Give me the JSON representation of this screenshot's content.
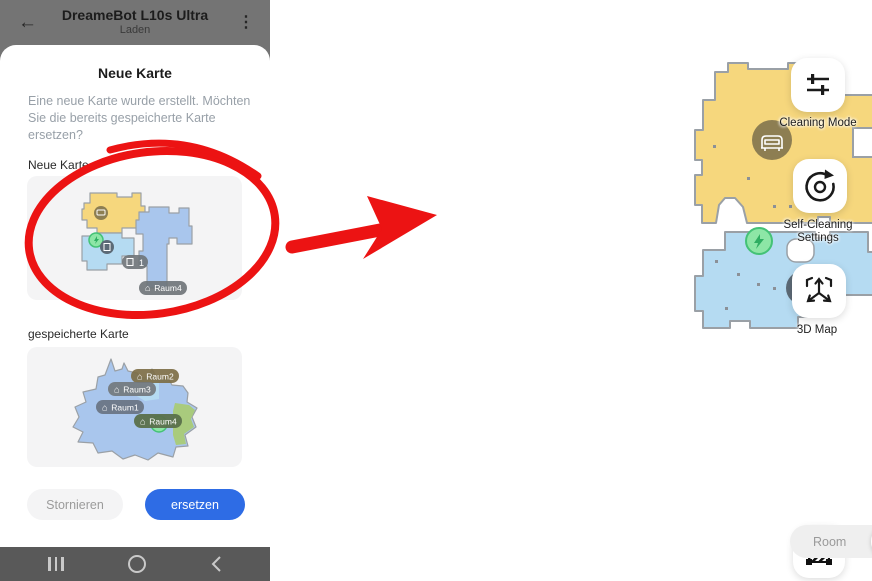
{
  "icons": {
    "back": "←",
    "menu": "⋮",
    "house": "⌂"
  },
  "phone": {
    "header": {
      "title": "DreameBot L10s Ultra",
      "subtitle": "Laden"
    },
    "dialog": {
      "title": "Neue Karte",
      "message": "Eine neue Karte wurde erstellt. Möchten Sie die bereits gespeicherte Karte ersetzen?",
      "sections": {
        "new_map": "Neue Karte",
        "saved_map": "gespeicherte Karte"
      },
      "new_map_pills": {
        "dock": "1",
        "room": "Raum4"
      },
      "saved_map_pills": [
        "Raum2",
        "Raum3",
        "Raum1",
        "Raum4"
      ],
      "buttons": {
        "cancel": "Stornieren",
        "confirm": "ersetzen"
      }
    }
  },
  "map_view": {
    "action_buttons": [
      {
        "id": "cleaning-mode",
        "label": "Cleaning Mode"
      },
      {
        "id": "self-cleaning-settings",
        "label": "Self-Cleaning Settings"
      },
      {
        "id": "3d-map",
        "label": "3D Map"
      },
      {
        "id": "restricted-zone",
        "label": ""
      }
    ],
    "mode_switch": {
      "options": [
        "Room",
        "All",
        "Zone"
      ],
      "selected": "All"
    }
  },
  "colors": {
    "accent_blue": "#2e6ce5",
    "annotation_red": "#ec1313",
    "room_yellow": "#f6d77d",
    "room_light_blue": "#b5dbf2",
    "room_blue": "#a9c6ed",
    "room_green": "#a9cb7d",
    "room_mop_blue": "#cfe7f8",
    "wall_gray": "#9aa0a6"
  }
}
